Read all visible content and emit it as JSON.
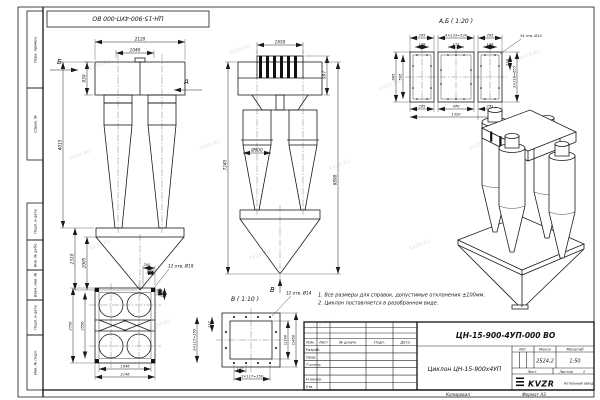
{
  "sheet": {
    "stamp": "ЦН-15-900-4УП-000 ВО",
    "watermark": "KVZR.RU",
    "margin_labels": [
      "Перв. примен.",
      "Справ. №",
      "Подп. и дата",
      "Инв. № дубл.",
      "Взам. инв. №",
      "Подп. и дата",
      "Инв. № подл."
    ]
  },
  "views": {
    "side": {
      "arrow_b": "Б",
      "arrow_a": "А",
      "d_top": "2120",
      "d_inner": "1040",
      "d_header": "930",
      "d_body": "4015",
      "d_hopper": "2310",
      "d_cone": "2005"
    },
    "front": {
      "arrow_v": "В",
      "d_top": "1650",
      "d_inlet": "997",
      "d_dia": "Ø900",
      "d_left": "7245",
      "d_right": "6898"
    },
    "flange_ab": {
      "title": "А,Б ( 1:20 )",
      "d295a": "295",
      "d530": "4×133=530",
      "d295b": "295",
      "d148a": "148",
      "d133": "133",
      "d148b": "148",
      "d685": "685",
      "d595": "595",
      "d218": "218",
      "d655": "3×218=655",
      "holes": "34 отв. Ø14",
      "d235a": "235",
      "d470": "470",
      "d235b": "235",
      "d1320": "1320"
    },
    "plan": {
      "d2756": "2756",
      "d2556": "2556",
      "d1946": "1946",
      "d2146": "2146",
      "d200": "200",
      "d140": "140",
      "d140v": "140",
      "d200v": "200",
      "holes": "12 отв. Ø18"
    },
    "flange_v": {
      "title": "В ( 1:10 )",
      "d117l": "117",
      "pitch_l": "3×117=350",
      "d117b": "117",
      "pitch_b": "3×117=350",
      "holes": "12 отв. Ø14",
      "sq_in": "□390",
      "sq_out": "□460"
    }
  },
  "notes": {
    "line1": "1. Все размеры для справок, допустимые отклонения ±100мм.",
    "line2": "2. Циклон поставляется в разобранном виде."
  },
  "title_block": {
    "designation": "ЦН-15-900-4УП-000 ВО",
    "name": "Циклон ЦН-15-900х4УП",
    "change_header": [
      "Изм.",
      "Лист",
      "№ докум.",
      "Подп.",
      "Дата"
    ],
    "sig_rows": [
      "Разраб.",
      "Пров.",
      "Т.контр.",
      "",
      "Н.контр.",
      "Утв."
    ],
    "lit_label": "Лит.",
    "mass_label": "Масса",
    "scale_label": "Масштаб",
    "mass_value": "2524,2",
    "scale_value": "1:50",
    "sheet_label": "Лист",
    "sheets_label": "Листов",
    "sheets_value": "1",
    "logo_text": "KVZR",
    "company": "Котельный завод",
    "footer_copy": "Копировал",
    "footer_format": "Формат А3"
  }
}
